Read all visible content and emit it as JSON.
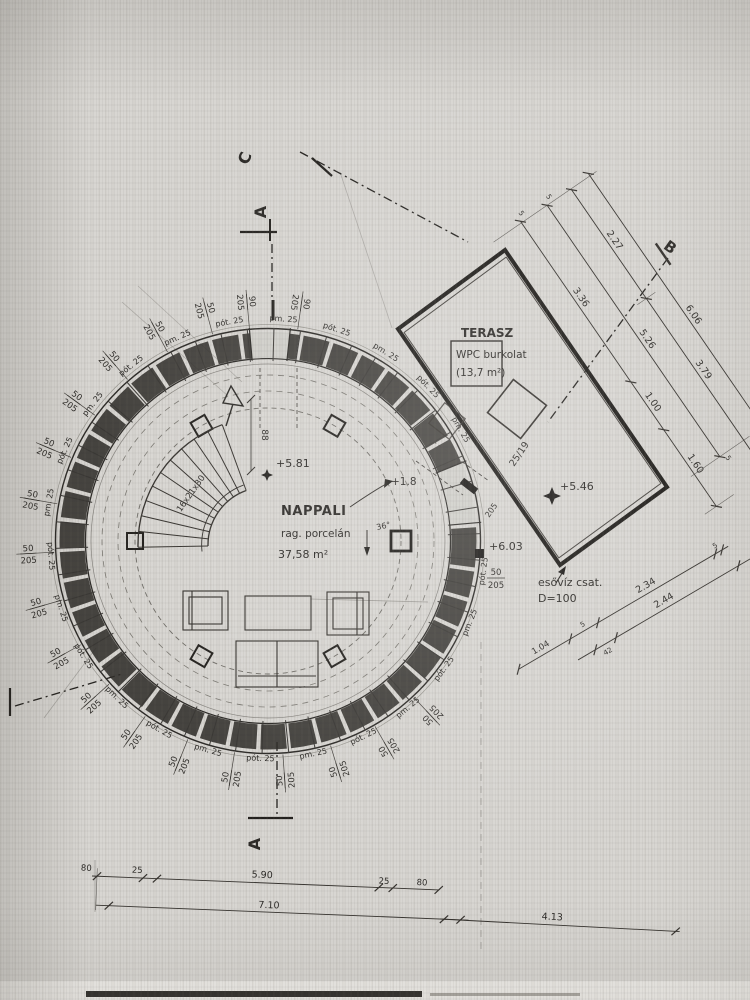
{
  "room": {
    "name": "NAPPALI",
    "finish": "rag. porcelán",
    "area": "37,58 m²",
    "level": "+5.81",
    "door_level": "+1.8",
    "angle_note": "36°",
    "stair_note": "16x21x30",
    "width_note": "88"
  },
  "terrace": {
    "name": "TERASZ",
    "finish": "WPC burkolat",
    "area": "(13,7 m²)",
    "level_high": "+6.03",
    "level_low": "+5.46",
    "beam_note": "25/19",
    "drain_line1": "esővíz csat.",
    "drain_line2": "D=100",
    "col_note_num": "50",
    "col_note_den": "205",
    "col_note": "205"
  },
  "sections": {
    "a": "A",
    "b": "B",
    "c": "C"
  },
  "ring": {
    "outer_num": "50",
    "outer_den": "205",
    "outer90_num": "90",
    "inner_labels": [
      "pm. 25",
      "pót. 25"
    ]
  },
  "dims": {
    "d227": "2.27",
    "d336": "3.36",
    "d526": "5.26",
    "d606": "6.06",
    "d379": "3.79",
    "d100": "1.00",
    "d160": "1.60",
    "d234": "2.34",
    "d244": "2.44",
    "d104": "1.04",
    "d42": "42",
    "small": "5",
    "b80": "80",
    "b25": "25",
    "b590": "5.90",
    "b25b": "25",
    "b80b": "80",
    "b710": "7.10",
    "b413": "4.13"
  },
  "colors": {
    "ink": "#2c2a27",
    "wall": "#2b2926",
    "paper": "#d8d6d2"
  }
}
